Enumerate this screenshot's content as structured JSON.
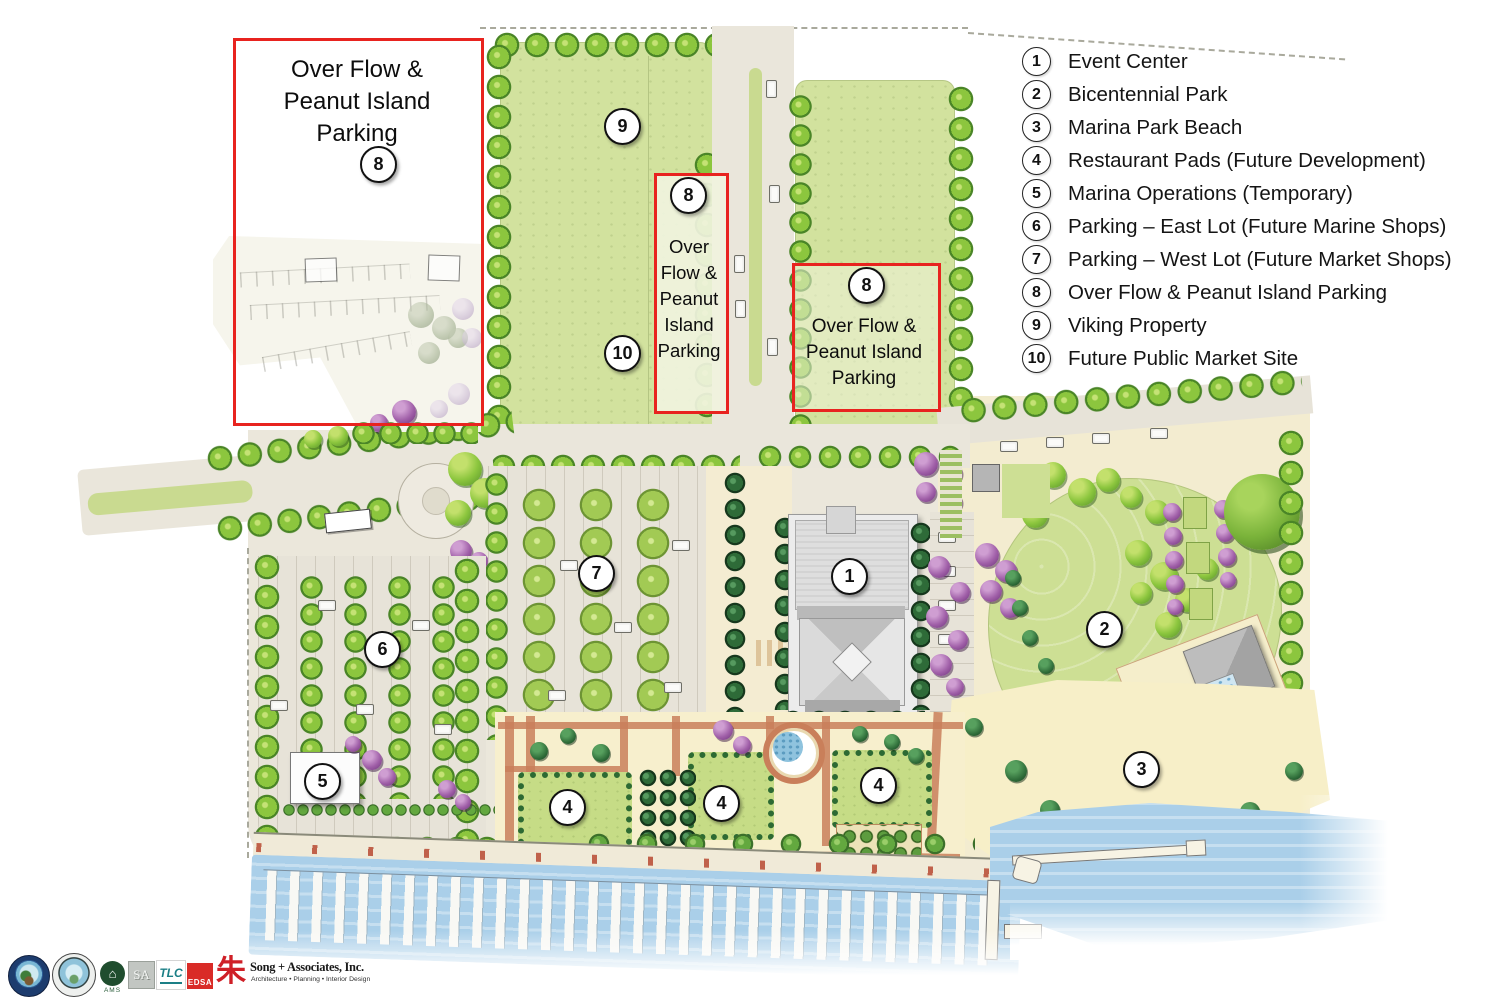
{
  "legend": {
    "items": [
      {
        "num": "1",
        "label": "Event Center"
      },
      {
        "num": "2",
        "label": "Bicentennial Park"
      },
      {
        "num": "3",
        "label": "Marina Park Beach"
      },
      {
        "num": "4",
        "label": "Restaurant Pads (Future Development)"
      },
      {
        "num": "5",
        "label": "Marina Operations (Temporary)"
      },
      {
        "num": "6",
        "label": "Parking – East Lot (Future Marine Shops)"
      },
      {
        "num": "7",
        "label": "Parking – West Lot (Future Market Shops)"
      },
      {
        "num": "8",
        "label": "Over Flow & Peanut Island Parking"
      },
      {
        "num": "9",
        "label": "Viking Property"
      },
      {
        "num": "10",
        "label": "Future Public Market Site"
      }
    ]
  },
  "overlays": {
    "box_nw": {
      "line1": "Over Flow &",
      "line2": "Peanut Island",
      "line3": "Parking"
    },
    "box_mid": {
      "lines": [
        "Over",
        "Flow &",
        "Peanut",
        "Island",
        "Parking"
      ]
    },
    "box_e": {
      "line1": "Over Flow &",
      "line2": "Peanut Island",
      "line3": "Parking"
    }
  },
  "map": {
    "markers": [
      {
        "label": "9"
      },
      {
        "label": "10"
      },
      {
        "label": "8"
      },
      {
        "label": "8"
      },
      {
        "label": "8"
      },
      {
        "label": "7"
      },
      {
        "label": "1"
      },
      {
        "label": "6"
      },
      {
        "label": "2"
      },
      {
        "label": "5"
      },
      {
        "label": "4"
      },
      {
        "label": "4"
      },
      {
        "label": "4"
      },
      {
        "label": "3"
      }
    ]
  },
  "footer": {
    "ams_label": "AMS",
    "sa_label": "SA",
    "tlc_label": "TLC",
    "edsa_label": "EDSA",
    "song_glyph": "朱",
    "song_name": "Song + Associates, Inc.",
    "song_tagline": "Architecture • Planning • Interior Design"
  },
  "colors": {
    "outline_red": "#e8231f",
    "field_green": "#d2e29e",
    "tree_green": "#8cc63e",
    "palm_green": "#2e6b38",
    "purple_tree": "#a05fa8",
    "water_blue": "#aacfe9",
    "sand": "#f7efc8",
    "pavement": "#e7e3d8",
    "terracotta": "#c97f5a",
    "edsa_red": "#d92b27"
  }
}
